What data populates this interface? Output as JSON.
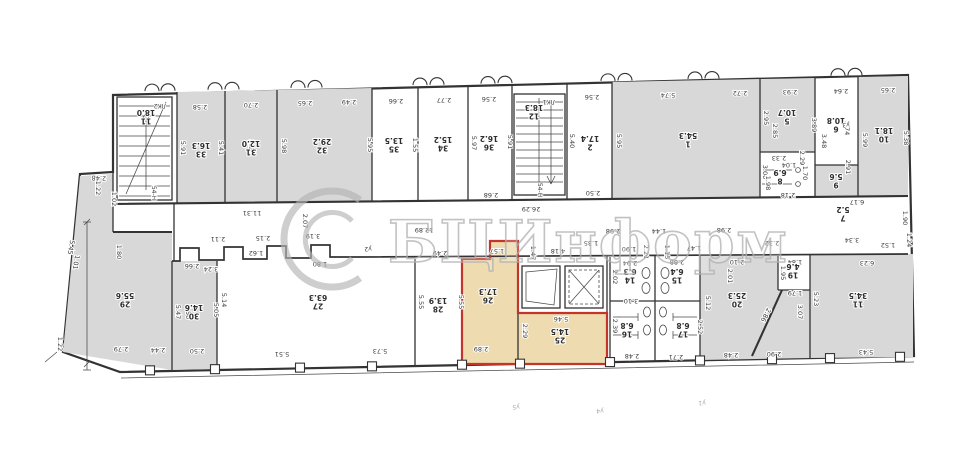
{
  "watermark": {
    "text": "БЦИнформ"
  },
  "colors": {
    "wall": "#333333",
    "room_gray": "#d8d8d8",
    "highlight_beige": "#eedcb0",
    "highlight_red": "#c2352b",
    "dim_text": "#3a3a3a",
    "watermark_gray": "#b3b3b3"
  },
  "plan": {
    "rooms": [
      {
        "no": "33",
        "area": "16.3",
        "x": 201,
        "y": 150
      },
      {
        "no": "31",
        "area": "12.0",
        "x": 251,
        "y": 148
      },
      {
        "no": "32",
        "area": "29.2",
        "x": 322,
        "y": 146
      },
      {
        "no": "35",
        "area": "13.5",
        "x": 394,
        "y": 145
      },
      {
        "no": "34",
        "area": "15.2",
        "x": 443,
        "y": 144
      },
      {
        "no": "36",
        "area": "16.2",
        "x": 489,
        "y": 143
      },
      {
        "no": "2",
        "area": "17.4",
        "x": 590,
        "y": 143
      },
      {
        "no": "1",
        "area": "54.3",
        "x": 688,
        "y": 140
      },
      {
        "no": "5",
        "area": "10.7",
        "x": 787,
        "y": 117
      },
      {
        "no": "6",
        "area": "10.8",
        "x": 836,
        "y": 125
      },
      {
        "no": "10",
        "area": "18.1",
        "x": 884,
        "y": 135
      },
      {
        "no": "8",
        "area": "6.9",
        "x": 780,
        "y": 177
      },
      {
        "no": "9",
        "area": "5.6",
        "x": 836,
        "y": 181
      },
      {
        "no": "7",
        "area": "5.2",
        "x": 843,
        "y": 214
      },
      {
        "no": "11",
        "area": "18.0",
        "x": 146,
        "y": 117
      },
      {
        "no": "12",
        "area": "18.3",
        "x": 534,
        "y": 112
      },
      {
        "no": "29",
        "area": "55.6",
        "x": 125,
        "y": 300
      },
      {
        "no": "30",
        "area": "14.6",
        "x": 194,
        "y": 312
      },
      {
        "no": "27",
        "area": "63.3",
        "x": 318,
        "y": 302
      },
      {
        "no": "28",
        "area": "13.9",
        "x": 438,
        "y": 305
      },
      {
        "no": "26",
        "area": "17.3",
        "x": 488,
        "y": 296
      },
      {
        "no": "25",
        "area": "14.5",
        "x": 560,
        "y": 336
      },
      {
        "no": "14",
        "area": "6.3",
        "x": 630,
        "y": 276
      },
      {
        "no": "15",
        "area": "6.4",
        "x": 677,
        "y": 276
      },
      {
        "no": "16",
        "area": "6.8",
        "x": 627,
        "y": 330
      },
      {
        "no": "17",
        "area": "6.8",
        "x": 683,
        "y": 330
      },
      {
        "no": "20",
        "area": "25.3",
        "x": 737,
        "y": 300
      },
      {
        "no": "19",
        "area": "4.6",
        "x": 793,
        "y": 271
      },
      {
        "no": "11",
        "area": "34.5",
        "x": 858,
        "y": 300
      }
    ],
    "dims": [
      [
        "2.58",
        200,
        105,
        180
      ],
      [
        "2.70",
        251,
        103,
        180
      ],
      [
        "2.65",
        305,
        101,
        180
      ],
      [
        "2.49",
        349,
        100,
        180
      ],
      [
        "2.66",
        396,
        99,
        180
      ],
      [
        "2.77",
        444,
        98,
        180
      ],
      [
        "2.56",
        489,
        97,
        180
      ],
      [
        "2.56",
        592,
        95,
        180
      ],
      [
        "5.74",
        668,
        93,
        180
      ],
      [
        "2.72",
        740,
        91,
        180
      ],
      [
        "2.93",
        790,
        90,
        180
      ],
      [
        "2.64",
        841,
        89,
        180
      ],
      [
        "2.65",
        888,
        88,
        180
      ],
      [
        "5.91",
        181,
        148,
        90
      ],
      [
        "5.41",
        219,
        148,
        90
      ],
      [
        "5.93",
        249,
        147,
        90
      ],
      [
        "5.98",
        282,
        146,
        90
      ],
      [
        "5.95",
        368,
        145,
        90
      ],
      [
        "1.55",
        413,
        145,
        90
      ],
      [
        "5.97",
        472,
        143,
        90
      ],
      [
        "5.91",
        508,
        142,
        90
      ],
      [
        "5.40",
        570,
        141,
        90
      ],
      [
        "5.95",
        617,
        141,
        90
      ],
      [
        "2.95",
        764,
        118,
        90
      ],
      [
        "2.85",
        773,
        131,
        90
      ],
      [
        "3.89",
        812,
        125,
        90
      ],
      [
        "3.48",
        822,
        141,
        90
      ],
      [
        "3.74",
        845,
        128,
        90
      ],
      [
        "2.91",
        846,
        167,
        90
      ],
      [
        "5.99",
        863,
        140,
        90
      ],
      [
        "5.38",
        904,
        138,
        90
      ],
      [
        "3.00",
        763,
        172,
        90
      ],
      [
        "2.29",
        800,
        158,
        90
      ],
      [
        "1.04",
        789,
        163,
        180
      ],
      [
        "2.33",
        779,
        156,
        180
      ],
      [
        "1.70",
        803,
        173,
        90
      ],
      [
        "2.18",
        788,
        193,
        180
      ],
      [
        "1.98",
        766,
        183,
        90
      ],
      [
        "11.31",
        252,
        211,
        180
      ],
      [
        "2.68",
        491,
        193,
        180
      ],
      [
        "26.29",
        531,
        207,
        180
      ],
      [
        "2.50",
        593,
        191,
        180
      ],
      [
        "12.89",
        424,
        228,
        180
      ],
      [
        "2.11",
        218,
        237,
        180
      ],
      [
        "2.15",
        263,
        236,
        180
      ],
      [
        "3.19",
        313,
        234,
        180
      ],
      [
        "2.07",
        303,
        221,
        90
      ],
      [
        "1.62",
        256,
        251,
        180
      ],
      [
        "1.80",
        320,
        262,
        180
      ],
      [
        "2.49",
        440,
        251,
        180
      ],
      [
        "1.57",
        497,
        249,
        180
      ],
      [
        "4.18",
        558,
        249,
        180
      ],
      [
        "1.47",
        531,
        253,
        90
      ],
      [
        "1.35",
        591,
        241,
        180
      ],
      [
        "2.98",
        613,
        229,
        180
      ],
      [
        "1.44",
        659,
        229,
        180
      ],
      [
        "1.90",
        629,
        247,
        180
      ],
      [
        "1.47",
        694,
        246,
        180
      ],
      [
        "1.15",
        665,
        252,
        90
      ],
      [
        "2.21",
        644,
        252,
        90
      ],
      [
        "2.32",
        772,
        241,
        180
      ],
      [
        "3.34",
        852,
        238,
        180
      ],
      [
        "1.52",
        888,
        243,
        180
      ],
      [
        "1.24",
        907,
        240,
        90
      ],
      [
        "2.98",
        724,
        228,
        180
      ],
      [
        "6.17",
        857,
        200,
        180
      ],
      [
        "1.90",
        903,
        218,
        90
      ],
      [
        "3.24",
        211,
        267,
        180
      ],
      [
        "2.66",
        192,
        264,
        180
      ],
      [
        "5.47",
        176,
        312,
        90
      ],
      [
        "5.50",
        186,
        312,
        90
      ],
      [
        "5.05",
        214,
        310,
        90
      ],
      [
        "5.14",
        222,
        300,
        90
      ],
      [
        "2.79",
        121,
        347,
        180
      ],
      [
        "2.44",
        158,
        348,
        180
      ],
      [
        "2.50",
        197,
        349,
        180
      ],
      [
        "5.51",
        282,
        352,
        180
      ],
      [
        "5.73",
        380,
        349,
        180
      ],
      [
        "5.55",
        419,
        302,
        90
      ],
      [
        "5.55",
        459,
        302,
        90
      ],
      [
        "2.89",
        481,
        347,
        180
      ],
      [
        "2.29",
        523,
        331,
        90
      ],
      [
        "5.46",
        561,
        317,
        180
      ],
      [
        "2.94",
        630,
        261,
        180
      ],
      [
        "2.88",
        677,
        260,
        180
      ],
      [
        "3.10",
        631,
        299,
        180
      ],
      [
        "2.48",
        632,
        354,
        180
      ],
      [
        "2.71",
        676,
        355,
        180
      ],
      [
        "2.02",
        613,
        277,
        90
      ],
      [
        "2.39",
        613,
        326,
        90
      ],
      [
        "2.52",
        698,
        327,
        90
      ],
      [
        "2.10",
        737,
        260,
        180
      ],
      [
        "2.01",
        728,
        276,
        90
      ],
      [
        "1.84",
        795,
        260,
        180
      ],
      [
        "1.95",
        781,
        273,
        90
      ],
      [
        "1.79",
        795,
        291,
        180
      ],
      [
        "2.86",
        764,
        314,
        118
      ],
      [
        "5.12",
        706,
        303,
        90
      ],
      [
        "2.48",
        731,
        353,
        180
      ],
      [
        "2.90",
        774,
        352,
        180
      ],
      [
        "3.07",
        798,
        312,
        90
      ],
      [
        "5.23",
        814,
        299,
        90
      ],
      [
        "6.23",
        867,
        261,
        180
      ],
      [
        "5.43",
        866,
        350,
        180
      ],
      [
        "2.48",
        99,
        176,
        183
      ],
      [
        "1.22",
        96,
        188,
        90
      ],
      [
        "1.01",
        74,
        262,
        100
      ],
      [
        "5.45",
        69,
        247,
        100
      ],
      [
        "1.22",
        58,
        344,
        90
      ],
      [
        "1.80",
        117,
        252,
        90
      ],
      [
        "1.02",
        112,
        199,
        90
      ]
    ],
    "tiny_labels": [
      [
        "ЛК2",
        160,
        104,
        180,
        0
      ],
      [
        "ЛК1",
        549,
        100,
        180,
        0
      ],
      [
        "54-Н",
        152,
        193,
        90,
        0
      ],
      [
        "54-Н",
        538,
        190,
        90,
        0
      ],
      [
        "у2",
        368,
        247,
        180,
        0
      ],
      [
        "у3",
        846,
        123,
        180,
        0
      ],
      [
        "у5",
        516,
        405,
        180,
        1
      ],
      [
        "у4",
        600,
        409,
        180,
        1
      ],
      [
        "у1",
        702,
        401,
        180,
        1
      ]
    ],
    "window_bumps": [
      152,
      168,
      215,
      232,
      298,
      315,
      420,
      437,
      488,
      505,
      608,
      625,
      695,
      712,
      838,
      855
    ],
    "wall_ticks": [
      150,
      215,
      300,
      372,
      462,
      520,
      610,
      700,
      772,
      830,
      900
    ]
  }
}
